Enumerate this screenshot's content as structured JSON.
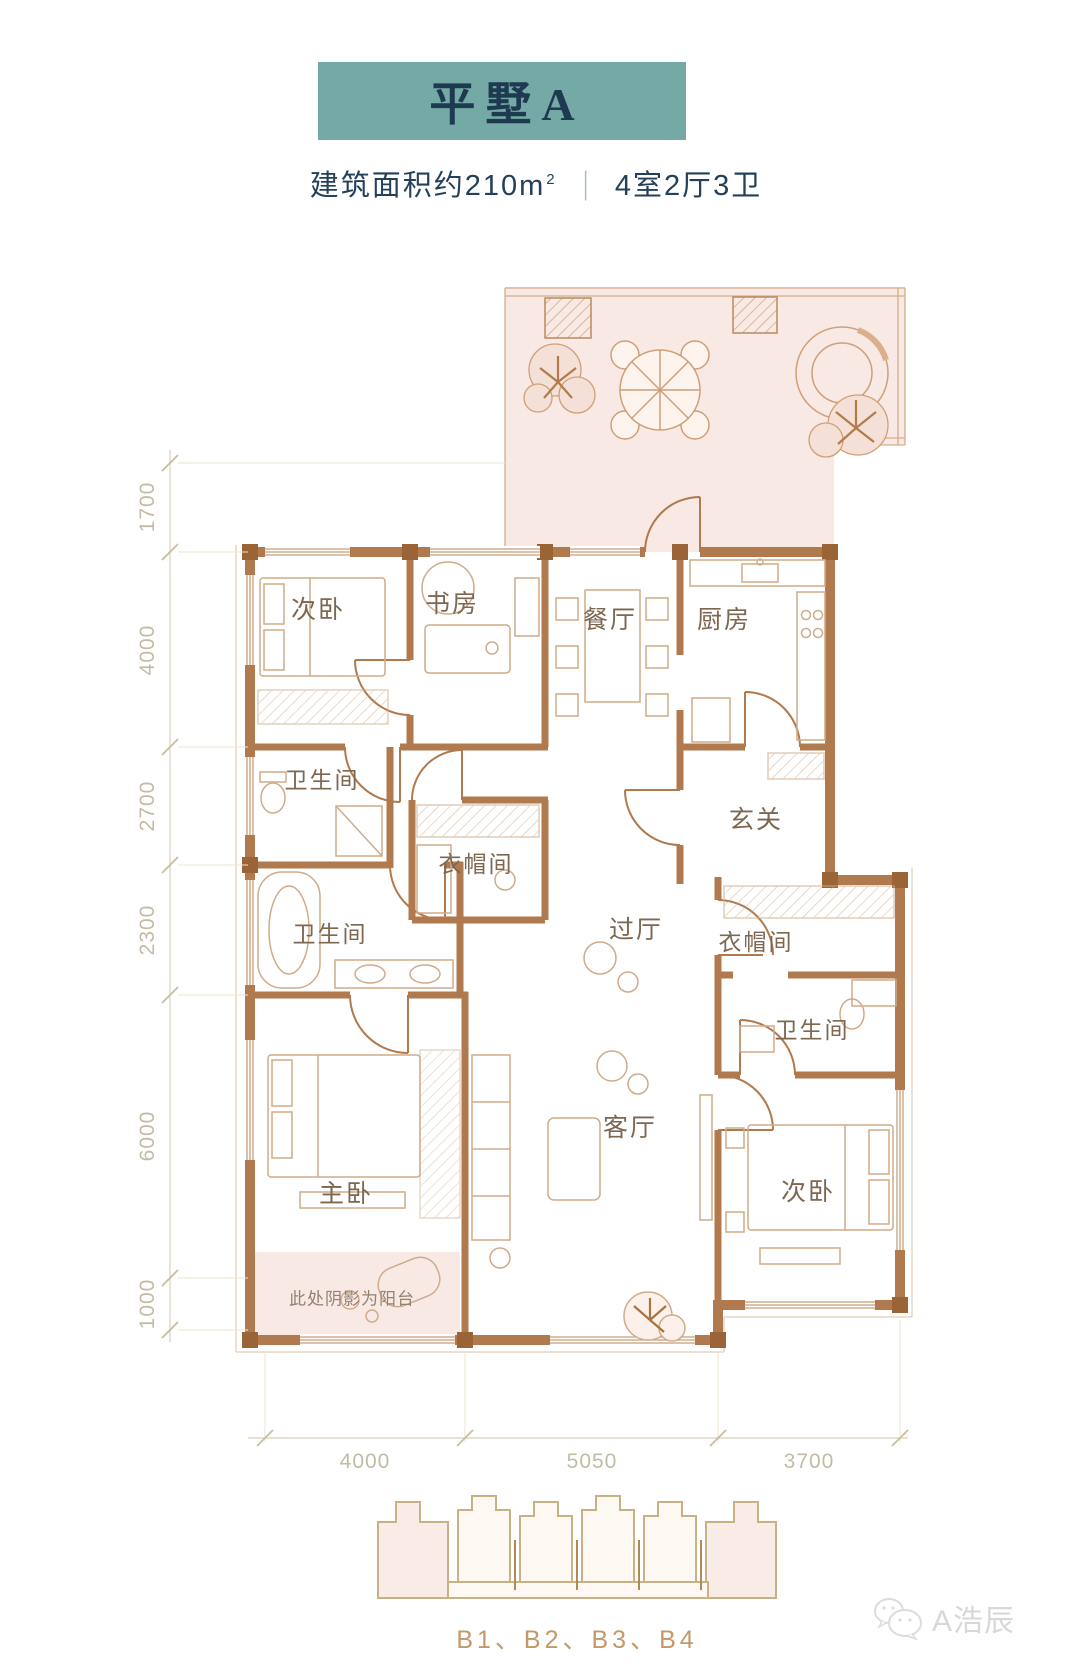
{
  "header": {
    "title": "平墅A",
    "area": "建筑面积约210m",
    "area_sup": "2",
    "divider": "|",
    "layout": "4室2厅3卫"
  },
  "colors": {
    "banner": "#74a9a5",
    "title_text": "#1d3a50",
    "wall": "#b1794e",
    "balcony_shade": "#f8e9e4",
    "dim_text": "#c3bba6",
    "room_label": "#7d6751",
    "keyplan_caption": "#c49868"
  },
  "plan": {
    "rooms": [
      {
        "label": "次卧"
      },
      {
        "label": "书房"
      },
      {
        "label": "餐厅"
      },
      {
        "label": "厨房"
      },
      {
        "label": "卫生间"
      },
      {
        "label": "衣帽间"
      },
      {
        "label": "玄关"
      },
      {
        "label": "过厅"
      },
      {
        "label": "衣帽间"
      },
      {
        "label": "卫生间"
      },
      {
        "label": "卫生间"
      },
      {
        "label": "主卧"
      },
      {
        "label": "客厅"
      },
      {
        "label": "次卧"
      }
    ],
    "balcony_note": "此处阴影为阳台",
    "dims_left": [
      {
        "label": "1700"
      },
      {
        "label": "4000"
      },
      {
        "label": "2700"
      },
      {
        "label": "2300"
      },
      {
        "label": "6000"
      },
      {
        "label": "1000"
      }
    ],
    "dims_bottom": [
      {
        "label": "4000"
      },
      {
        "label": "5050"
      },
      {
        "label": "3700"
      }
    ]
  },
  "keyplan": {
    "caption": "B1、B2、B3、B4"
  },
  "watermark": {
    "label": "A浩辰"
  }
}
